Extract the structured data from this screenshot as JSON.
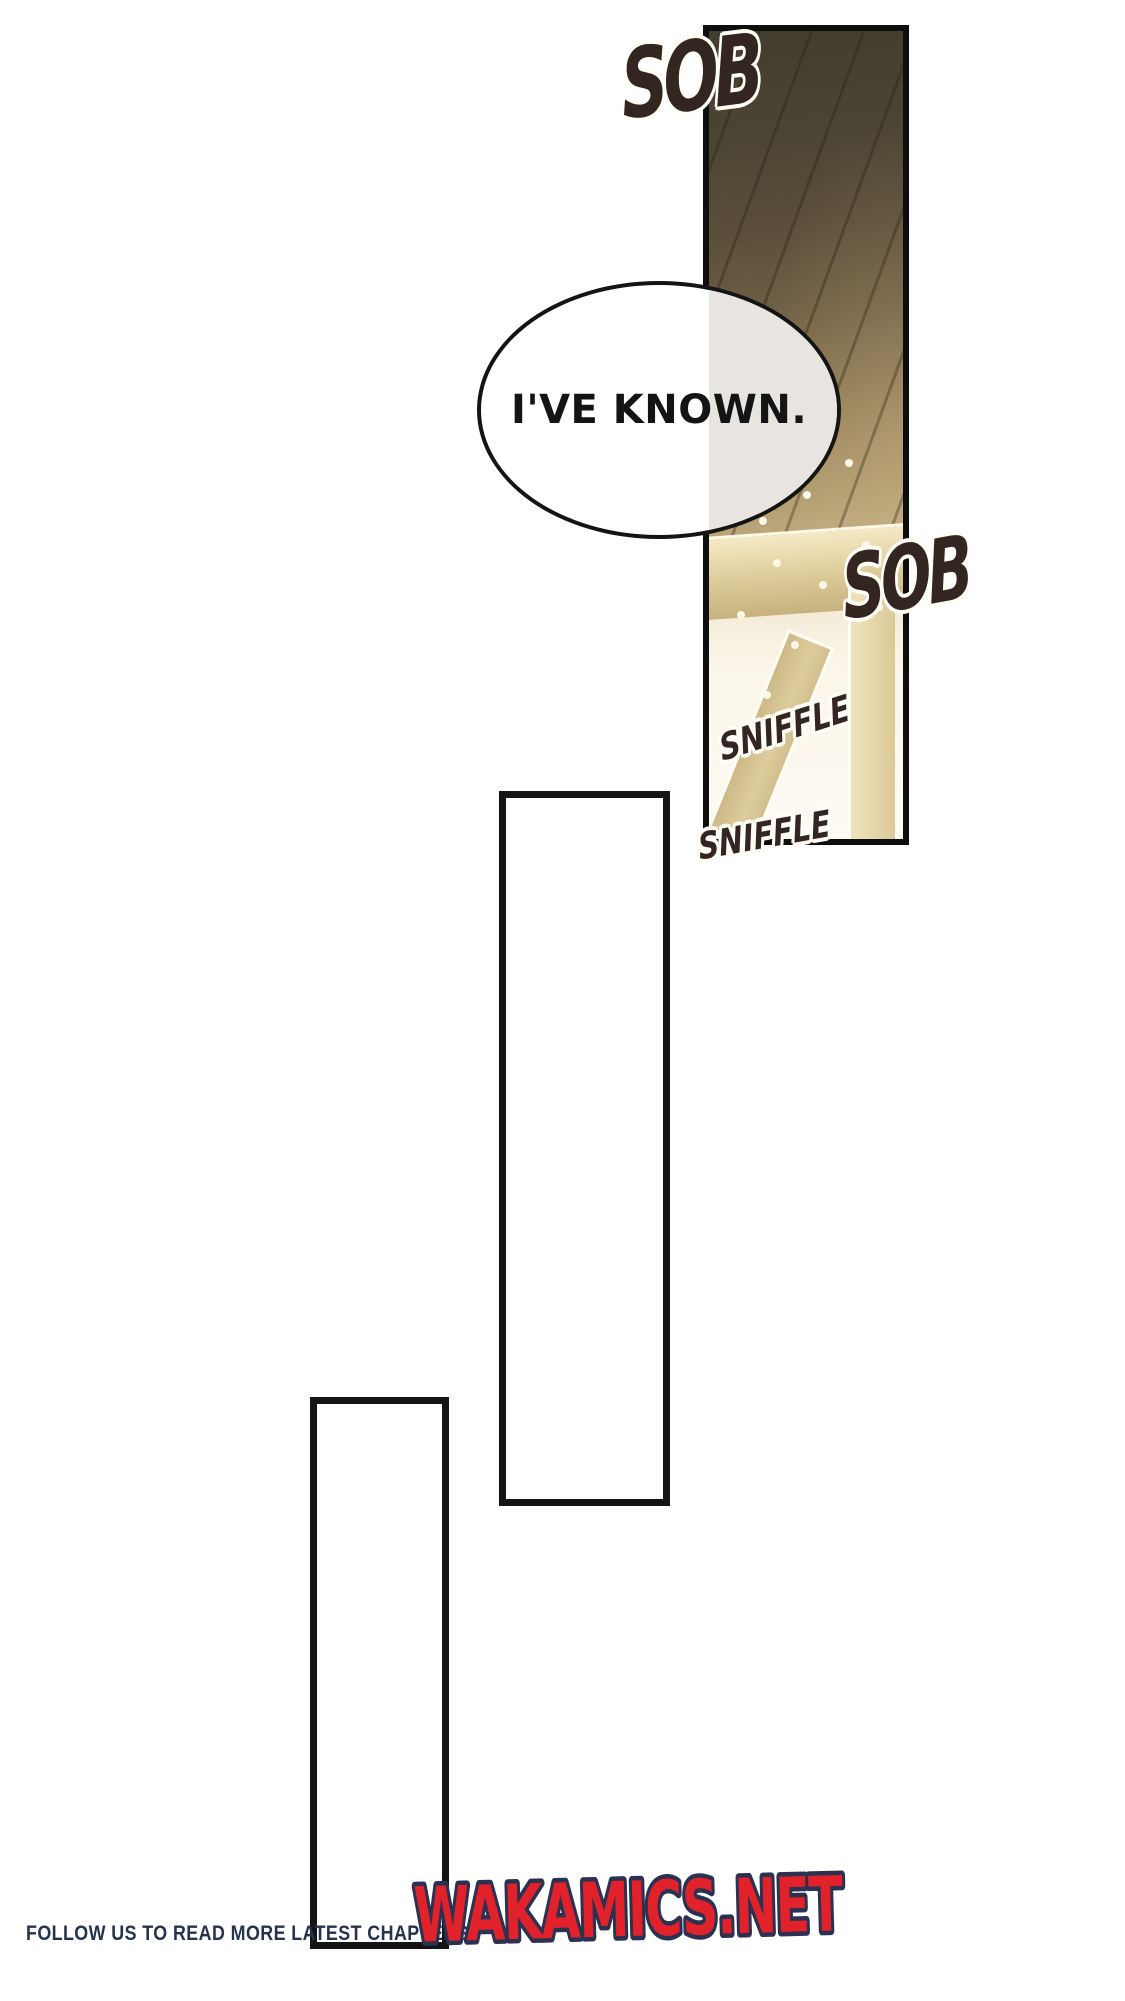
{
  "page": {
    "background_color": "#ffffff",
    "kind": "webtoon chapter page"
  },
  "image_panel": {
    "description": "wooden ceiling with beams and window light",
    "border_color": "#0e0e0e",
    "wood_dark": "#433d2f",
    "wood_light": "#d5c69c",
    "beam_color": "#d8c694",
    "light_color": "#fdfbf4"
  },
  "speech_bubble": {
    "text": "I'VE KNOWN.",
    "text_color": "#141414",
    "fill": "#ffffff",
    "overlay_tint": "#e8e5e1",
    "border_color": "#141414"
  },
  "sfx": {
    "sob_top": "SOB",
    "sob_middle": "SOB",
    "sniffle_upper": "SNIFFLE",
    "sniffle_lower": "SNIFFLE",
    "ink_color": "#33251f",
    "halo_color": "#fffdf5"
  },
  "footer": {
    "tagline": "FOLLOW US TO READ MORE LATEST CHAPTERS",
    "tagline_color": "#26334f",
    "site": "WAKAMICS.NET",
    "site_fill": "#e2222a",
    "site_outline": "#2b3150"
  }
}
